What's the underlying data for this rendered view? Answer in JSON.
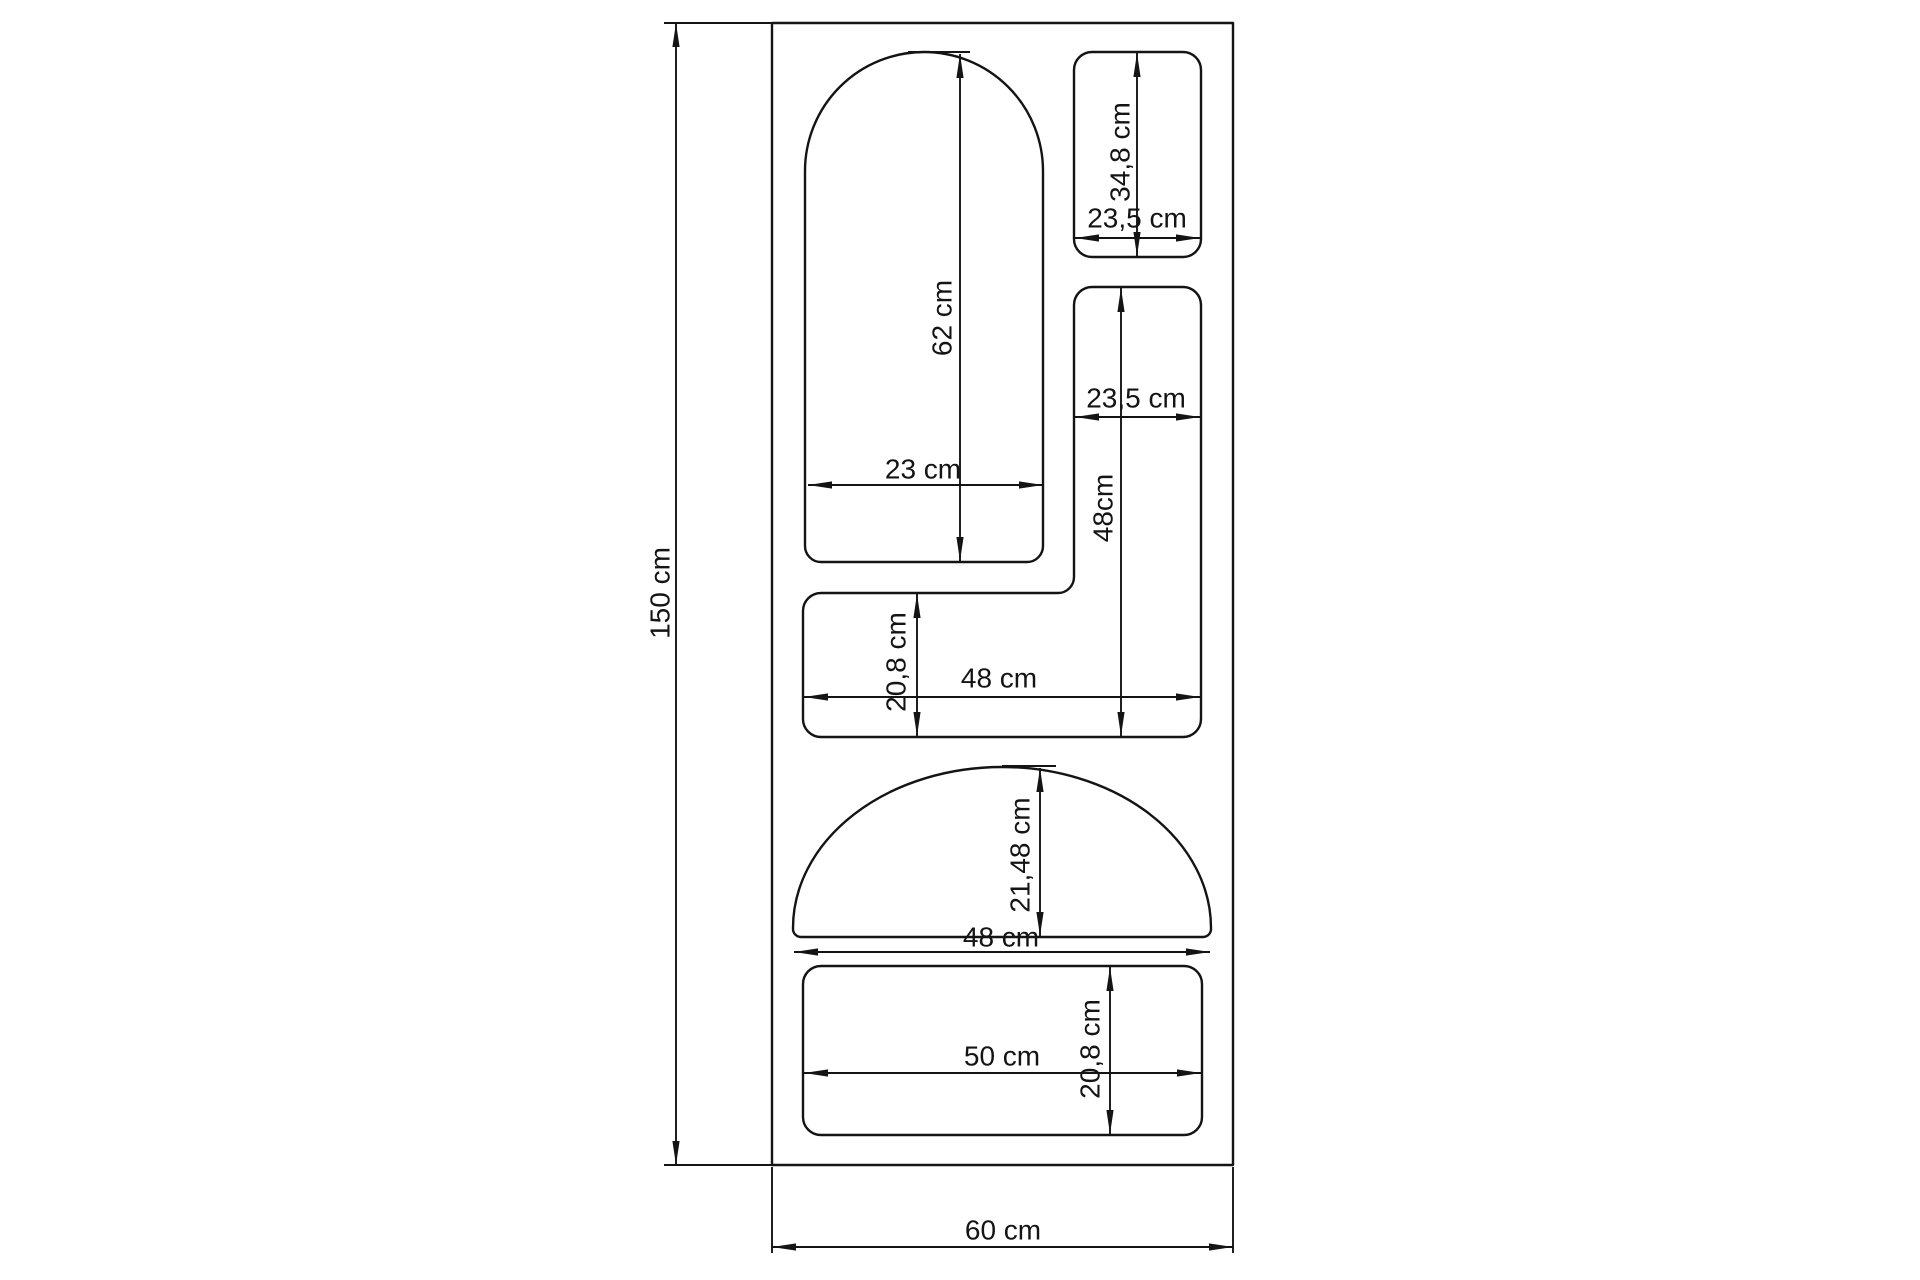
{
  "drawing": {
    "unit": "cm",
    "dims": {
      "total_height": "150 cm",
      "total_width": "60 cm",
      "arch_height": "62 cm",
      "arch_width": "23 cm",
      "top_rect_height": "34,8 cm",
      "top_rect_width": "23,5 cm",
      "mid_rect_width": "23,5 cm",
      "mid_rect_height": "48cm",
      "band_height": "20,8 cm",
      "band_width": "48 cm",
      "dome_height": "21,48 cm",
      "dome_width": "48 cm",
      "bottom_rect_width": "50 cm",
      "bottom_rect_height": "20,8 cm"
    },
    "shapes": [
      {
        "name": "outer panel",
        "width": "60 cm",
        "height": "150 cm"
      },
      {
        "name": "arched cutout",
        "width": "23 cm",
        "height": "62 cm"
      },
      {
        "name": "small rounded rectangle cutout",
        "width": "23,5 cm",
        "height": "34,8 cm"
      },
      {
        "name": "L-shaped cutout upright",
        "width": "23,5 cm",
        "height": "48cm"
      },
      {
        "name": "L-shaped cutout band",
        "width": "48 cm",
        "height": "20,8 cm"
      },
      {
        "name": "dome cutout",
        "width": "48 cm",
        "height": "21,48 cm"
      },
      {
        "name": "bottom rounded rectangle cutout",
        "width": "50 cm",
        "height": "20,8 cm"
      }
    ]
  }
}
